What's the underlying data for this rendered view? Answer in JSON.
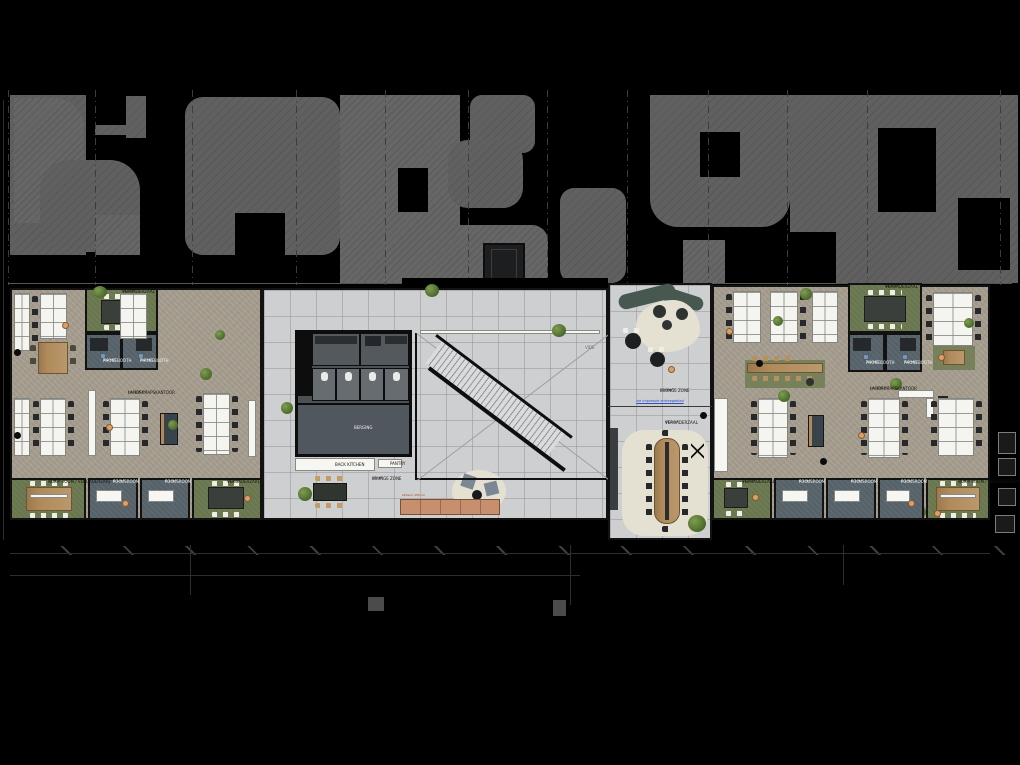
{
  "drawing": {
    "type": "office floor plan",
    "style": "top-down architectural plan on black background"
  },
  "colors": {
    "background": "#000000",
    "carpet": "#a79e8f",
    "tile": "#cdcfd1",
    "green_room": "#6e7c54",
    "blue_room": "#5c6870",
    "wood": "#b08a5a",
    "bench": "#c88f6f",
    "rug": "#e4e1d2",
    "accent_link": "#2b50c8",
    "site_hatch": "#5d5d5d"
  },
  "left_wing": {
    "label": {
      "name": "LANDSCHAPSKANTOOR",
      "area": "ca. 130 m²"
    },
    "meeting_top": {
      "name": "VERGADERZAAL",
      "area": "14,5 m²"
    },
    "phonebooth_1": {
      "name": "PHONEBOOTH",
      "area": "3,0 m²"
    },
    "phonebooth_2": {
      "name": "PHONEBOOTH",
      "area": "3,0 m²"
    },
    "quiet_room": {
      "name": "QUIET ROOM / VERGADERZAAL",
      "area": "14,9 m²"
    },
    "focusroom_1": {
      "name": "FOCUSROOM",
      "area": "6,1 m²"
    },
    "focusroom_2": {
      "name": "FOCUSROOM",
      "area": "6,1 m²"
    },
    "meeting_bottom": {
      "name": "VERGADERZAAL",
      "area": "12,8 m²"
    }
  },
  "center": {
    "back_kitchen_label": "BACK KITCHEN",
    "pantry_label": "PANTRY",
    "storage_label": "BERGING",
    "lounge": {
      "name": "LOUNGE ZONE",
      "area": "48 m²"
    },
    "bench_note": "zitbank 450 cm",
    "void_label": "VIDE"
  },
  "lobby": {
    "lounge": {
      "name": "LOUNGE ZONE",
      "area": "31,5 m²"
    },
    "link_text": "zie impressie entreegebied",
    "meeting": {
      "name": "VERGADERZAAL",
      "area": "43,9 m²"
    }
  },
  "right_wing": {
    "label": {
      "name": "LANDSCHAPSKANTOOR",
      "area": "ca. 130 m²"
    },
    "meeting_top": {
      "name": "VERGADERZAAL",
      "area": "14,5 m²"
    },
    "phonebooth_1": {
      "name": "PHONEBOOTH",
      "area": "3,0 m²"
    },
    "phonebooth_2": {
      "name": "PHONEBOOTH",
      "area": "3,0 m²"
    },
    "meeting_bottom": {
      "name": "VERGADERZAAL",
      "area": "12,8 m²"
    },
    "focusroom_1": {
      "name": "FOCUSROOM",
      "area": "6,1 m²"
    },
    "focusroom_2": {
      "name": "FOCUSROOM",
      "area": "6,1 m²"
    },
    "focusroom_3": {
      "name": "FOCUSROOM",
      "area": "6,1 m²"
    },
    "quiet_room": {
      "name": "QUIET ROOM / VERGADERZAAL",
      "area": "14,9 m²"
    }
  }
}
